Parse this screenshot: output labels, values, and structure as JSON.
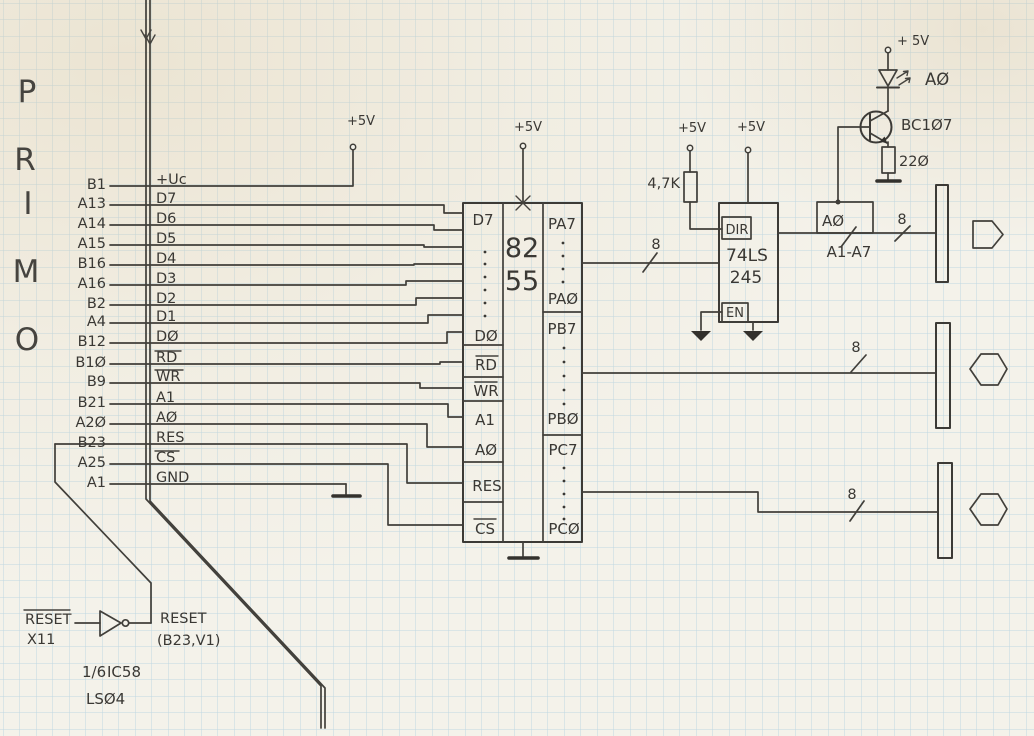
{
  "primo": {
    "letters": [
      "P",
      "R",
      "I",
      "M",
      "O"
    ]
  },
  "bus_rows": [
    {
      "pin": "B1",
      "signal": "+Uc"
    },
    {
      "pin": "A13",
      "signal": "D7"
    },
    {
      "pin": "A14",
      "signal": "D6"
    },
    {
      "pin": "A15",
      "signal": "D5"
    },
    {
      "pin": "B16",
      "signal": "D4"
    },
    {
      "pin": "A16",
      "signal": "D3"
    },
    {
      "pin": "B2",
      "signal": "D2"
    },
    {
      "pin": "A4",
      "signal": "D1"
    },
    {
      "pin": "B12",
      "signal": "DØ"
    },
    {
      "pin": "B1Ø",
      "signal": "RD"
    },
    {
      "pin": "B9",
      "signal": "WR"
    },
    {
      "pin": "B21",
      "signal": "A1"
    },
    {
      "pin": "A2Ø",
      "signal": "AØ"
    },
    {
      "pin": "B23",
      "signal": "RES"
    },
    {
      "pin": "A25",
      "signal": "CS"
    },
    {
      "pin": "A1",
      "signal": "GND"
    }
  ],
  "power": {
    "plus5v": "+5V",
    "plus5v_spaced": "+ 5V"
  },
  "bus_width": "8",
  "ic8255": {
    "name_line1": "82",
    "name_line2": "55",
    "left_pins": {
      "d7": "D7",
      "d0": "DØ",
      "rd": "RD",
      "wr": "WR",
      "a1": "A1",
      "a0": "AØ",
      "res": "RES",
      "cs": "CS"
    },
    "right_pins": {
      "pa7": "PA7",
      "pa0": "PAØ",
      "pb7": "PB7",
      "pb0": "PBØ",
      "pc7": "PC7",
      "pc0": "PCØ"
    }
  },
  "ic245": {
    "name_line1": "74LS",
    "name_line2": "245",
    "dir_pin": "DIR",
    "en_pin": "EN",
    "pullup_value": "4,7K"
  },
  "led_driver": {
    "transistor": "BC1Ø7",
    "led_signal": "AØ",
    "resistor": "22Ø"
  },
  "port_a_bus": {
    "bit_box": "AØ",
    "rest": "A1-A7"
  },
  "reset_gate": {
    "input": "RESET",
    "input_conn": "X11",
    "output": "RESET",
    "output_conn": "(B23,V1)",
    "fraction": "1/6",
    "ic": "IC58",
    "part": "LSØ4"
  }
}
